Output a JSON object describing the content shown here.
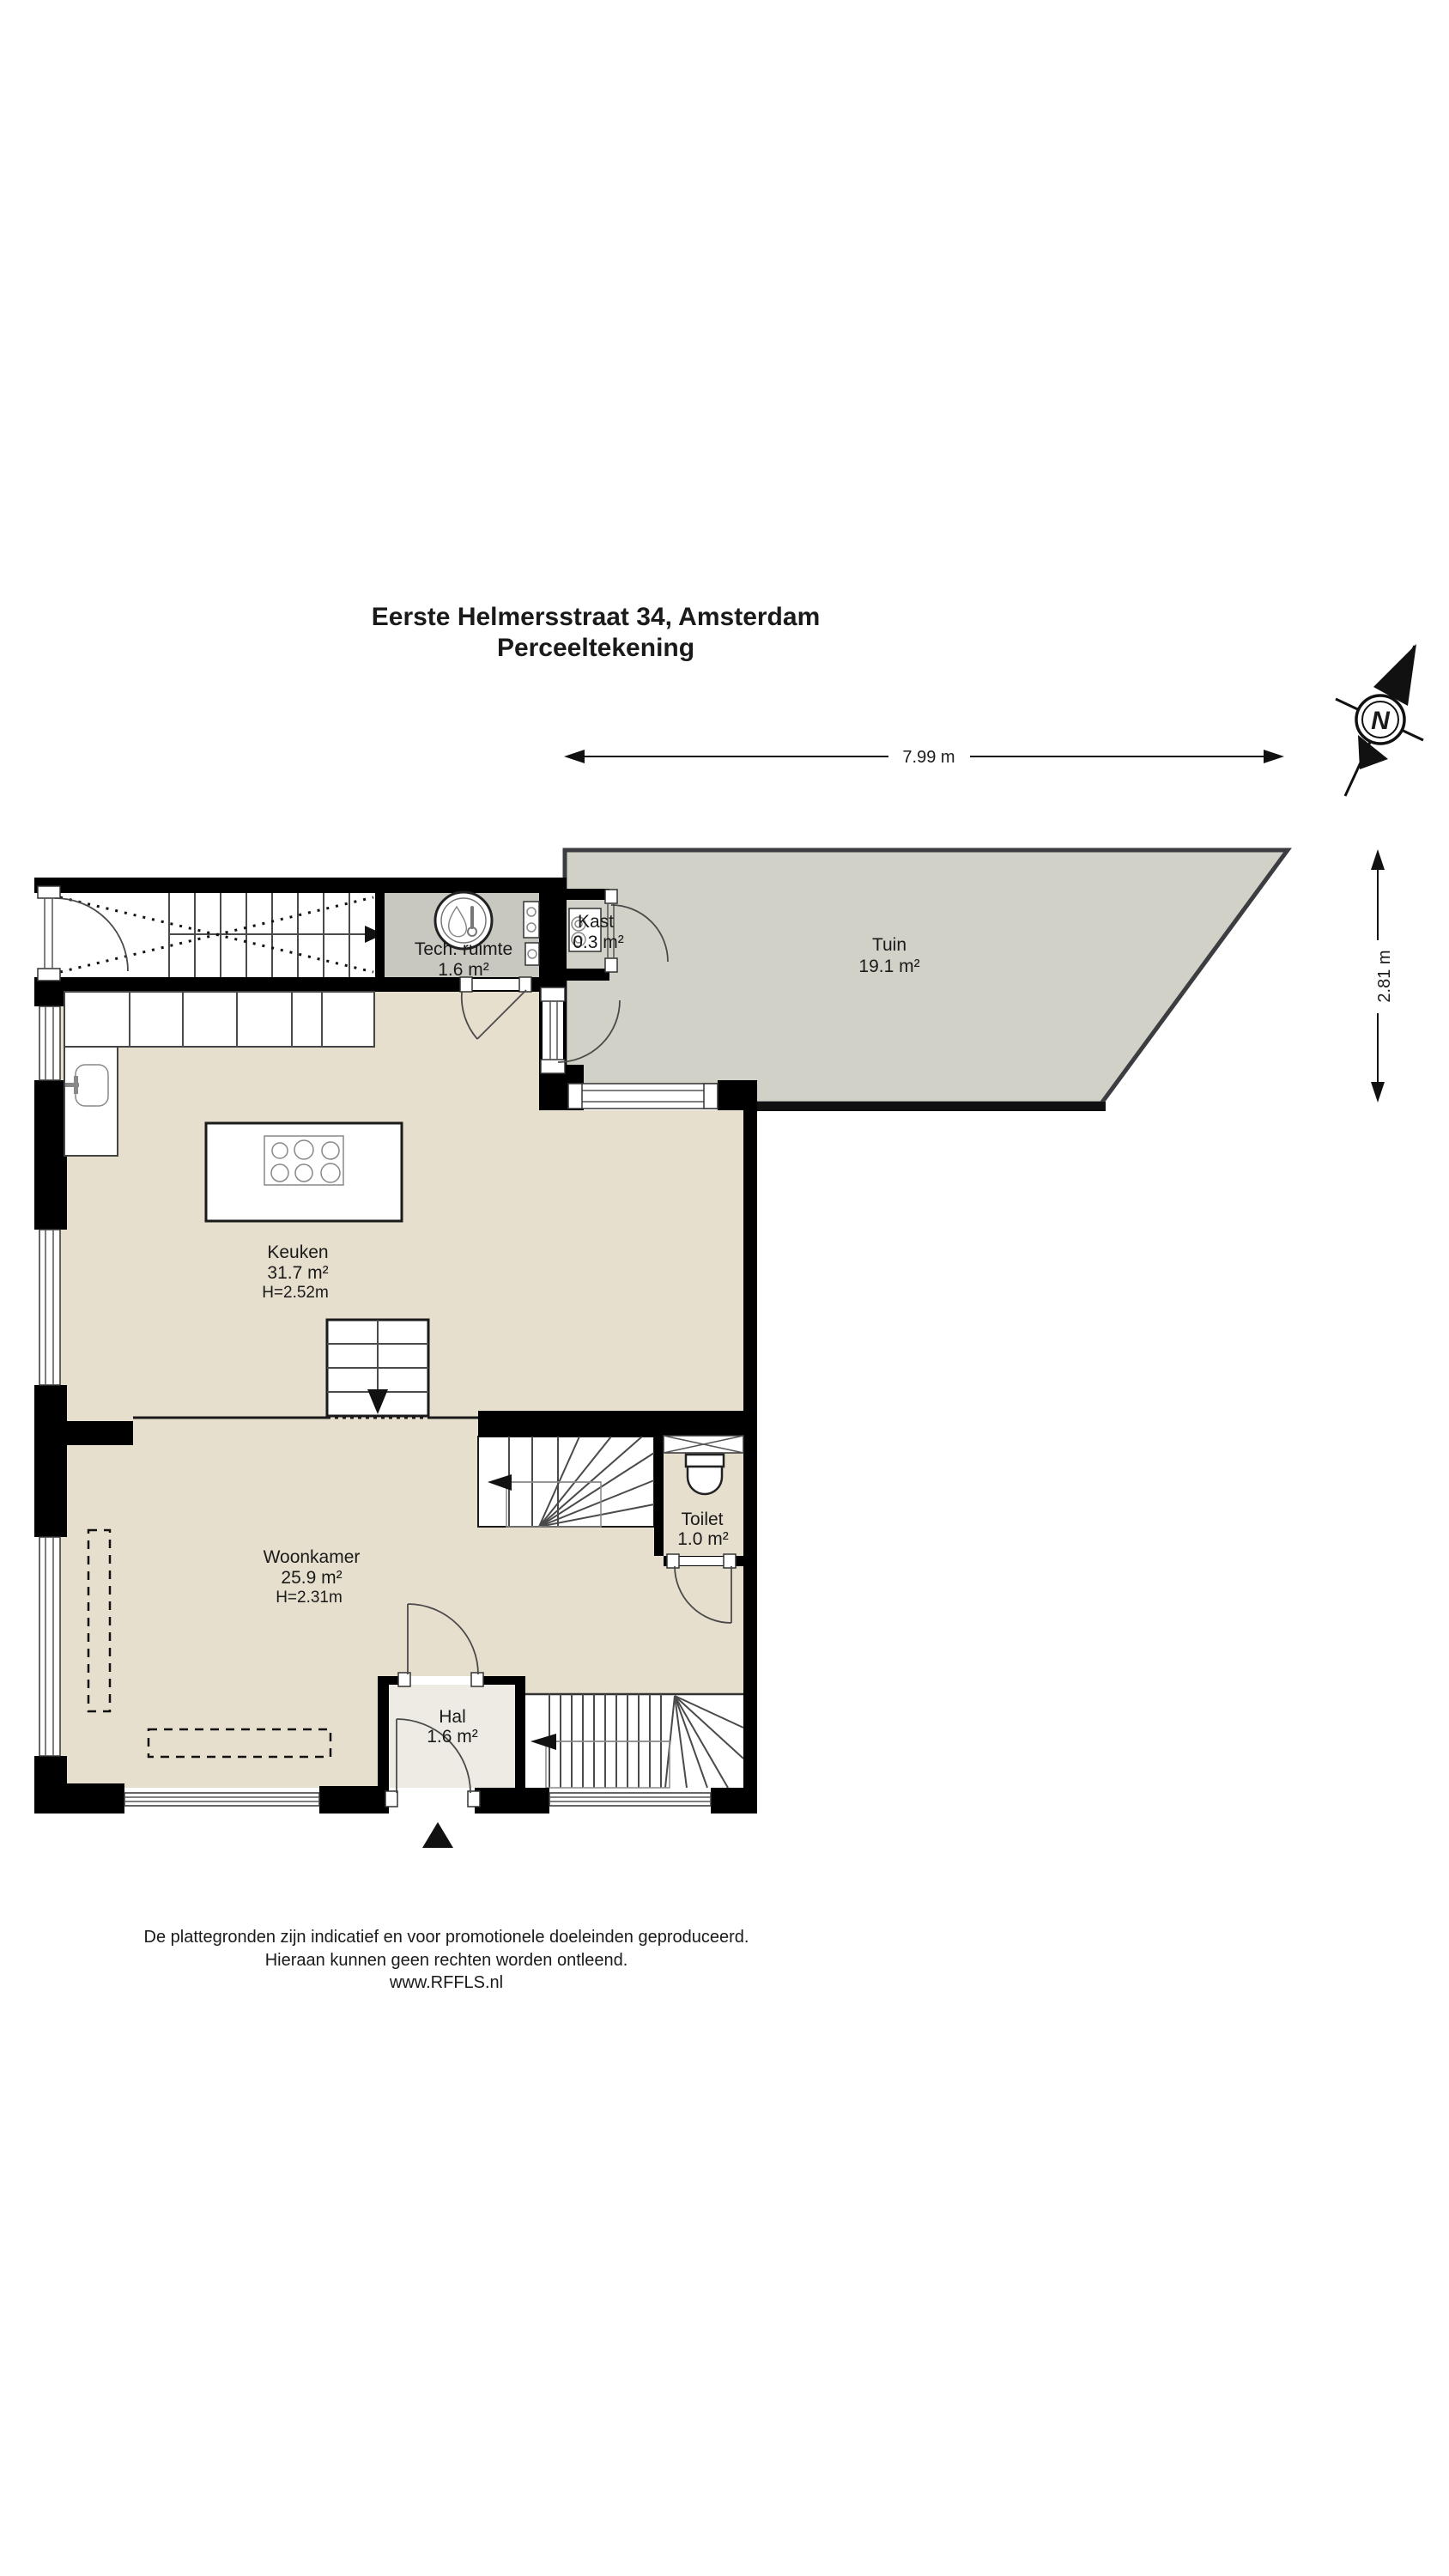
{
  "title": {
    "line1": "Eerste Helmersstraat 34, Amsterdam",
    "line2": "Perceeltekening"
  },
  "dimensions": {
    "width_label": "7.99 m",
    "depth_label": "2.81 m"
  },
  "compass": {
    "letter": "N"
  },
  "rooms": {
    "tech": {
      "name": "Tech. ruimte",
      "area": "1.6 m²"
    },
    "kast": {
      "name": "Kast",
      "area": "0.3 m²"
    },
    "tuin": {
      "name": "Tuin",
      "area": "19.1 m²"
    },
    "keuken": {
      "name": "Keuken",
      "area": "31.7 m²",
      "height": "H=2.52m"
    },
    "woonkamer": {
      "name": "Woonkamer",
      "area": "25.9 m²",
      "height": "H=2.31m"
    },
    "toilet": {
      "name": "Toilet",
      "area": "1.0 m²"
    },
    "hal": {
      "name": "Hal",
      "area": "1.6 m²"
    }
  },
  "footer": {
    "line1": "De plattegronden zijn indicatief en voor promotionele doeleinden geproduceerd.",
    "line2": "Hieraan kunnen geen rechten worden ontleend.",
    "line3": "www.RFFLS.nl"
  },
  "colors": {
    "floor_beige": "#e7dfce",
    "garden_gray": "#d2d1c7",
    "tech_gray": "#c9c8c0",
    "hal_gray": "#edebe3",
    "wall_black": "#000000",
    "garden_border": "#3c3d41"
  }
}
